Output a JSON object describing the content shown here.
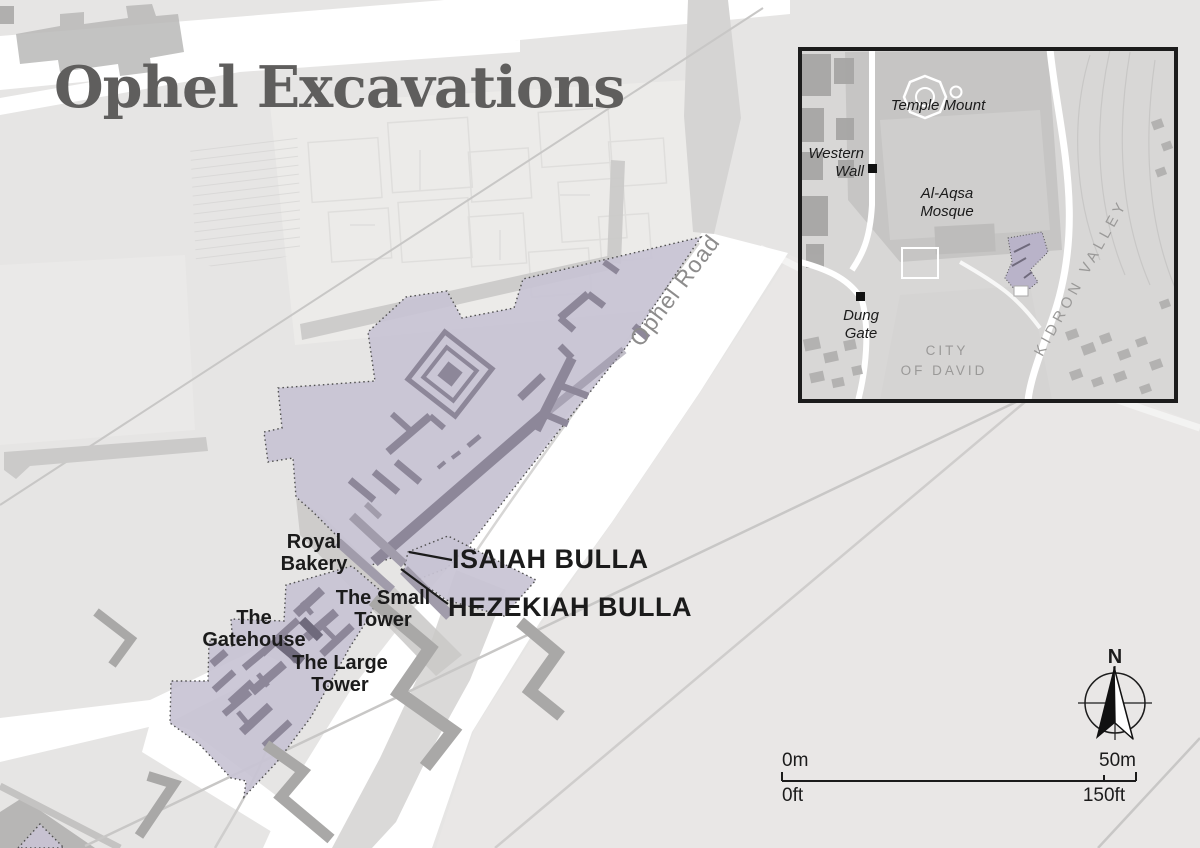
{
  "title": "Ophel Excavations",
  "colors": {
    "background": "#e6e5e4",
    "excavation_fill": "#c8c3d4",
    "excavation_wall": "#8d8799",
    "map_wall_gray": "#a9a8a7",
    "road_white": "#ffffff",
    "text_black": "#1b1b1b",
    "text_gray": "#8d8c8c",
    "title_color": "#5f5e5d"
  },
  "map": {
    "road_label": "Ophel Road",
    "area_labels": {
      "royal_bakery": [
        "Royal",
        "Bakery"
      ],
      "gatehouse": [
        "The",
        "Gatehouse"
      ],
      "small_tower": [
        "The Small",
        "Tower"
      ],
      "large_tower": [
        "The Large",
        "Tower"
      ]
    },
    "find_labels": {
      "isaiah": "ISAIAH BULLA",
      "hezekiah": "HEZEKIAH BULLA"
    }
  },
  "inset": {
    "labels": {
      "temple_mount": "Temple Mount",
      "western_wall": [
        "Western",
        "Wall"
      ],
      "al_aqsa_mosque": [
        "Al-Aqsa",
        "Mosque"
      ],
      "dung_gate": [
        "Dung",
        "Gate"
      ],
      "city_of_david": [
        "CITY",
        "OF DAVID"
      ],
      "kidron_valley": "KIDRON VALLEY"
    }
  },
  "compass": {
    "north": "N"
  },
  "scale_bar": {
    "meters_start": "0m",
    "meters_end": "50m",
    "feet_start": "0ft",
    "feet_end": "150ft"
  }
}
